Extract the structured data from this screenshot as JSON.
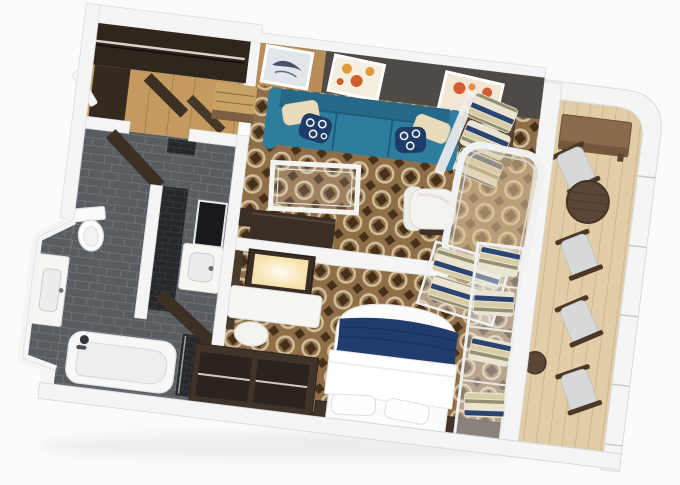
{
  "scene": {
    "type": "cruise-stateroom-3d-floor-plan",
    "view": "isometric-top-down",
    "rotation_deg": 7,
    "visible_text": ""
  },
  "inventory": {
    "artworks": 3,
    "sofa_pillows": 4,
    "linen_stacks": 9,
    "balcony_chairs": 4,
    "sinks": 2,
    "bathtubs": 1,
    "toilets": 1,
    "beds": 1
  },
  "colors": {
    "background": "#fbfbfa",
    "shadow": "#e2e2e0",
    "wall": "#f4f5f4",
    "wallEdge": "#d8dbdd",
    "topWallDark": "#4e4a45",
    "wardrobeDark": "#2f261e",
    "railLight": "#d8d3c8",
    "woodEntry": "#c49a5f",
    "entryCloset": "#352a20",
    "doorDark": "#3c2f23",
    "cabinetTop": "#c9a266",
    "cabinetFront": "#7c5f41",
    "artPanelWood": "#b98d58",
    "carpetBase": "#8f6e48",
    "carpetDark": "#45301a",
    "carpetCream": "#d8c9a4",
    "tileBase": "#595c61",
    "tileGrout": "#70737a",
    "tileDark": "#26282c",
    "white": "#fafaf9",
    "fixtureStroke": "#d7dadb",
    "tubInner": "#edefef",
    "mirrorDark": "#17191c",
    "sofa": "#2e7d9e",
    "sofaBack": "#256887",
    "pillowCream": "#e9dcba",
    "pillowNavy": "#1e3c68",
    "sideTable": "#584634",
    "lampBase": "#f2efe5",
    "glassFill": "rgba(255,255,255,0.14)",
    "chairWhite": "#f4f3ef",
    "chairBase": "#3f3126",
    "partitionCab": "#3b2f25",
    "mirrorFrame": "#3a2e24",
    "glow": "#f6e2ad",
    "deskWhite": "#f6f6f3",
    "dresser": "#3f332a",
    "dresserInner": "#2b231d",
    "bedWhite": "#fcfcfb",
    "bedNavy": "#203d6e",
    "console": "#41342a",
    "stripeBeige": "#d6cda6",
    "stripeNavy": "#2c4470",
    "stripeOlive": "#93916f",
    "stripeCream": "#eae5d3",
    "archWood": "#dfc9a2",
    "deck": "#e1cda6",
    "balconyTable": "#5a4635",
    "chairCushion": "#d7d8d9",
    "chairFrame": "#4b3827",
    "shelfWood": "#8a6a4a",
    "artBirdBg": "#e2e5e9",
    "artBird": "#45536b",
    "art2Bg": "#f5efdf",
    "art2a": "#e09b3a",
    "art2b": "#cf5f2e",
    "art3Bg": "#f3e6d4",
    "art3a": "#d65a36",
    "art3b": "#e78b4b"
  }
}
